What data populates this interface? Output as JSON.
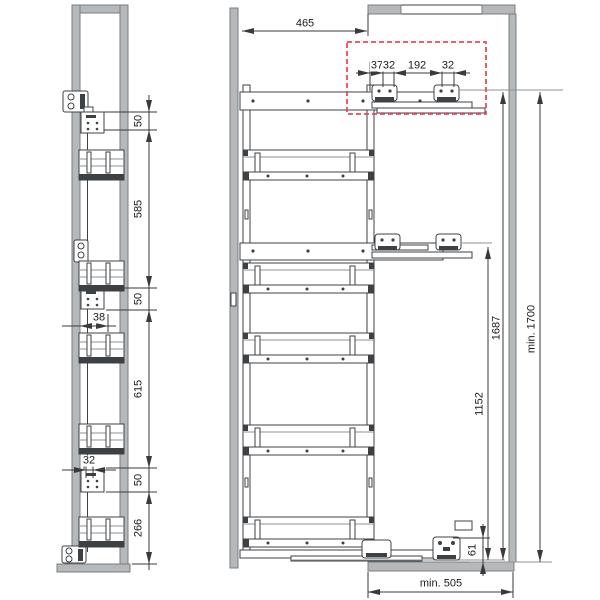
{
  "colors": {
    "panel": "#b6b9bb",
    "panel_edge": "#7a7d80",
    "line": "#3e4144",
    "line_light": "#8d9093",
    "dim": "#3a3a3a",
    "detail_box": "#e84a57",
    "text": "#1b1b1b"
  },
  "dims": {
    "side": {
      "top_offset": "50",
      "upper_span": "585",
      "mid_offset": "50",
      "bracket_inset": "38",
      "lower_span": "615",
      "hole_pitch": "32",
      "bottom_offset": "50",
      "bottom_span": "266"
    },
    "front": {
      "frame_depth": "465",
      "detail_offset_a": "37",
      "detail_offset_b": "32",
      "detail_span": "192",
      "detail_offset_c": "32",
      "mid_rail_height": "1152",
      "top_rail_height": "1687",
      "niche_height": "min. 1700",
      "floor_bracket_height": "61",
      "cabinet_depth": "min. 505"
    }
  }
}
